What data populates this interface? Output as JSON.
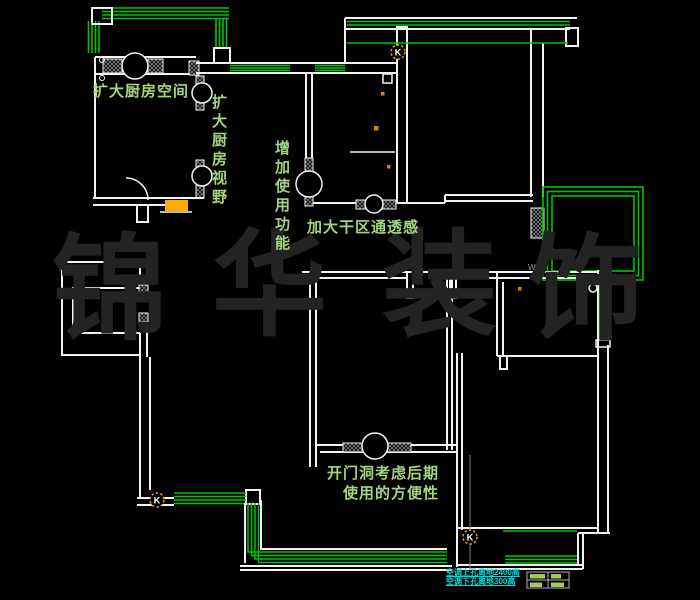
{
  "drawing": {
    "title": "renovation-floorplan",
    "watermark": {
      "chars": [
        "锦",
        "华",
        "装",
        "饰"
      ],
      "color": "#232323"
    },
    "annotations": {
      "expand_kitchen_space": "扩大厨房空间",
      "expand_kitchen_view": "扩大厨房视野",
      "add_usage_function": "增加使用功能",
      "enlarge_dry_area": "加大干区通透感",
      "door_opening_note_line1": "开门洞考虑后期",
      "door_opening_note_line2": "使用的方便性",
      "ac_hole_note_line1": "空调上孔离地2400高",
      "ac_hole_note_line2": "空调下孔离地300高",
      "wg_label": "WG",
      "switch_label": "K"
    },
    "colors": {
      "background": "#000000",
      "wall_line": "#F2F2F2",
      "window_line": "#00C400",
      "annotation_green": "#A5D67E",
      "watermark_gray": "#232323",
      "symbol_orange": "#E8960A",
      "counter_orange": "#FFAA00",
      "note_cyan": "#00DCDC",
      "leader_gray": "#808080",
      "table_cell_green": "#A4C85C"
    }
  }
}
